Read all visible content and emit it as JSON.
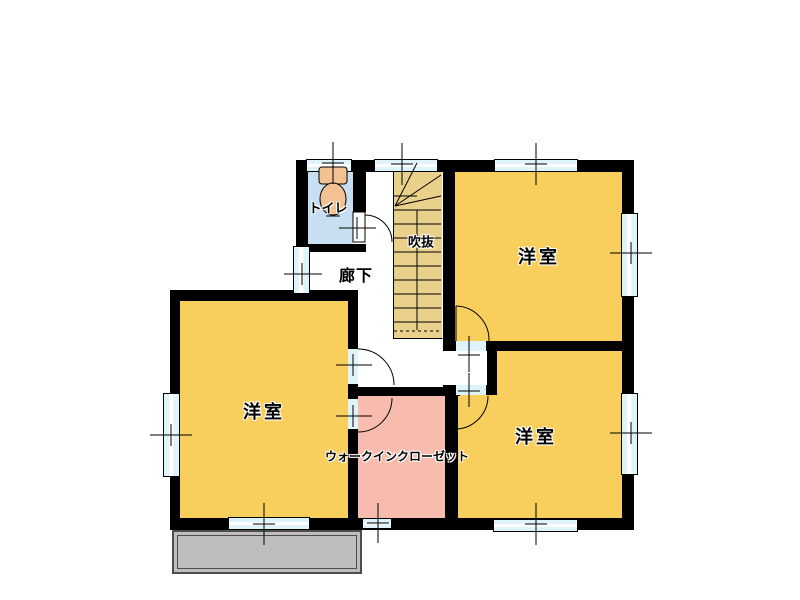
{
  "labels": {
    "toilet": "トイレ",
    "hallway": "廊下",
    "stairwell_void": "吹抜",
    "bedroom_ne": "洋室",
    "bedroom_se": "洋室",
    "bedroom_w": "洋室",
    "walk_in_closet": "ウォークインクローゼット"
  },
  "colors": {
    "room-yellow": "#F8CF5D",
    "stairs-tan": "#E9D08B",
    "closet-pink": "#F7BCAE",
    "toilet-blue": "#C8DFF1",
    "window-blue": "#DFF3FB",
    "fixture-peach": "#F4C193",
    "balcony-gray": "#BEBEBE",
    "wall-black": "#000000",
    "background": "#FFFFFF"
  }
}
